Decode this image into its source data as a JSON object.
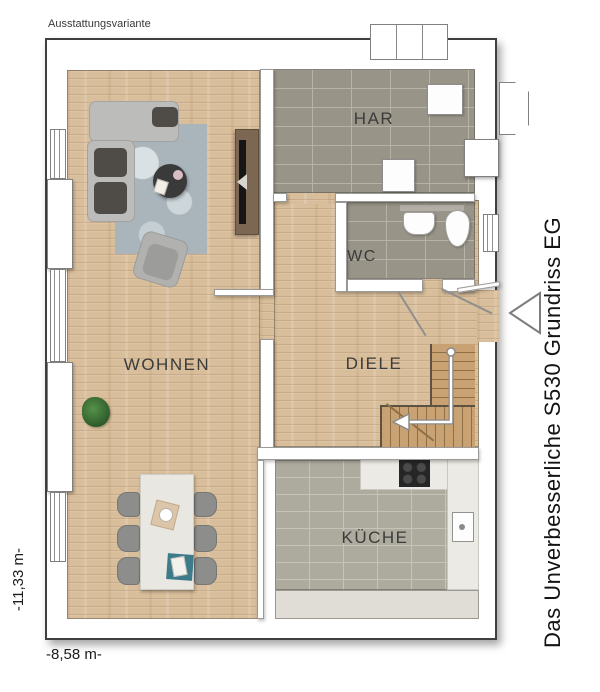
{
  "header": {
    "variant_label": "Ausstattungsvariante"
  },
  "side_title": {
    "text": "Das Unverbesserliche S530 Grundriss EG"
  },
  "dimensions": {
    "width_label": "-8,58 m-",
    "height_label": "-11,33 m-"
  },
  "rooms": {
    "har": {
      "label": "HAR"
    },
    "wc": {
      "label": "WC"
    },
    "wohnen": {
      "label": "WOHNEN"
    },
    "diele": {
      "label": "DIELE"
    },
    "kueche": {
      "label": "KÜCHE"
    }
  },
  "icons": {
    "entrance_arrow": "triangle-pointing-left",
    "stairs_arrow": "down-then-left-arrow"
  },
  "colors": {
    "wood_floor": "#d9be9b",
    "tile_dark": "#999488",
    "tile_light": "#adaa9e",
    "wall": "#ffffff",
    "outline": "#3f3f3f",
    "rug": "#a9b5bb",
    "sofa": "#bcbcba",
    "cushion_dark": "#4f4c48",
    "stairs_wood": "#c9a273",
    "accent_teal": "#3e7b8a"
  }
}
